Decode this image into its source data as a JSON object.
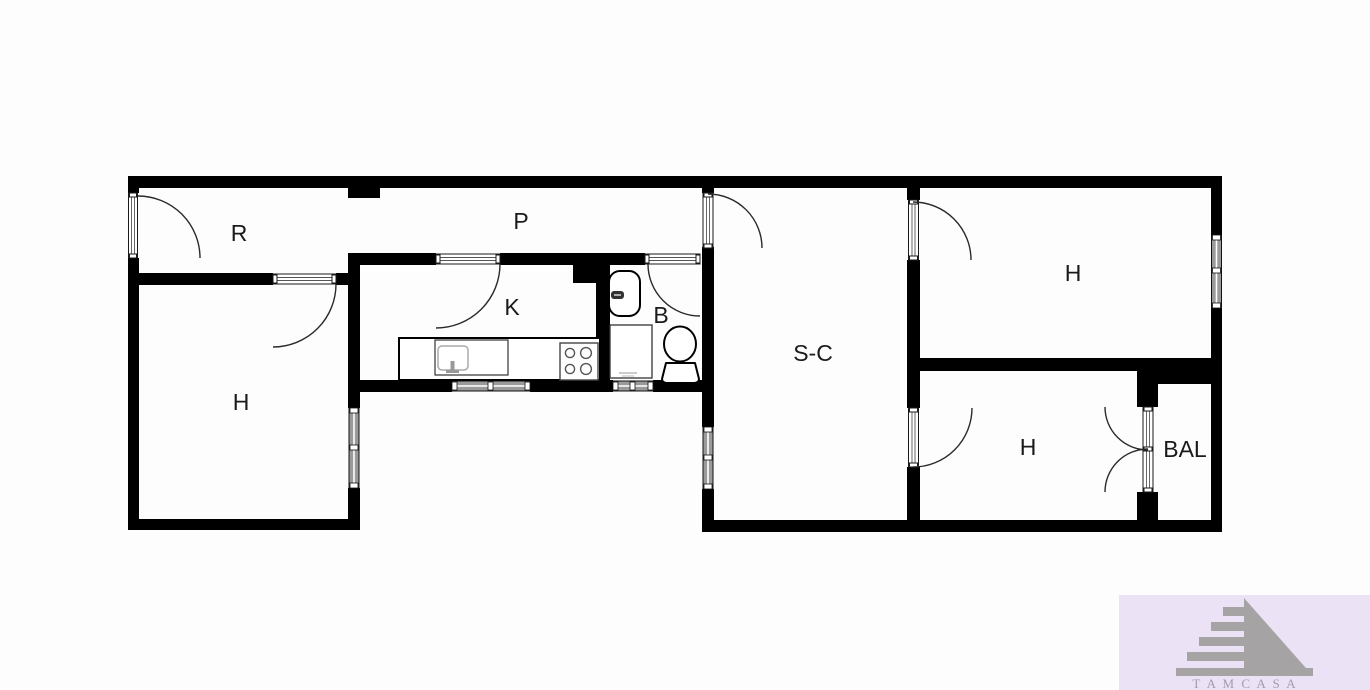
{
  "plan": {
    "rooms": {
      "r": {
        "label": "R"
      },
      "p": {
        "label": "P"
      },
      "k": {
        "label": "K"
      },
      "b": {
        "label": "B"
      },
      "sc": {
        "label": "S-C"
      },
      "h_left": {
        "label": "H"
      },
      "h_top_right": {
        "label": "H"
      },
      "h_bottom_right": {
        "label": "H"
      },
      "bal": {
        "label": "BAL"
      }
    }
  },
  "watermark": {
    "text": "T A M C A S A"
  },
  "colors": {
    "wall": "#000000",
    "background": "#fdfdfd",
    "window_fill": "#9a9a9a",
    "watermark_bg": "#ece2f5",
    "logo_gray": "#a6a3a5",
    "brand_text": "#a39cac"
  }
}
